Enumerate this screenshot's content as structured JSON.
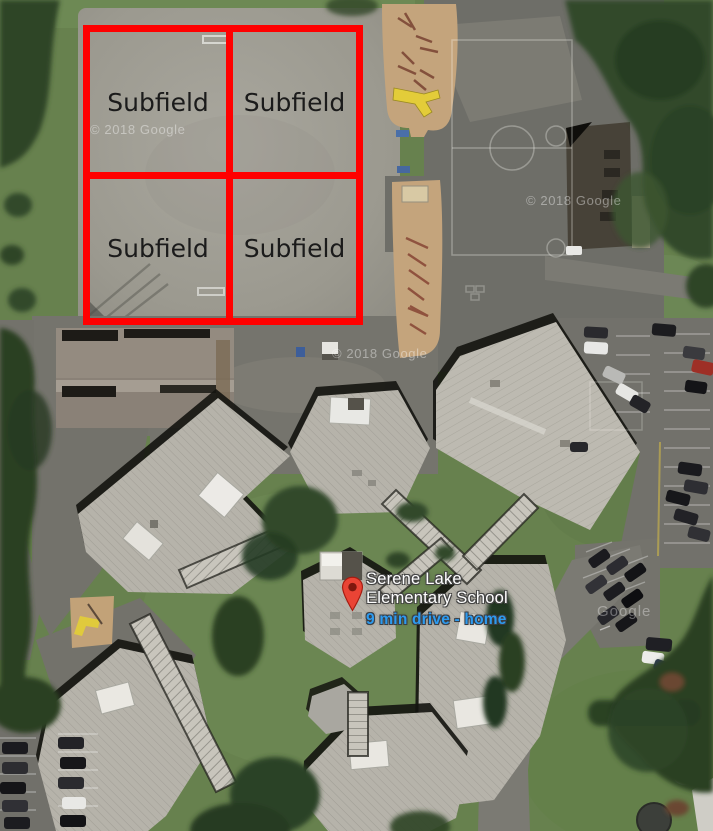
{
  "map": {
    "view": "satellite",
    "attribution": {
      "items": [
        {
          "text": "© 2018 Google"
        },
        {
          "text": "© 2018 Google"
        },
        {
          "text": "© 2018 Google"
        },
        {
          "text": "Google"
        }
      ]
    }
  },
  "overlay": {
    "grid_color": "#ff0000",
    "cells": [
      {
        "label": "Subfield"
      },
      {
        "label": "Subfield"
      },
      {
        "label": "Subfield"
      },
      {
        "label": "Subfield"
      }
    ]
  },
  "marker": {
    "pin_color": "#EA4435",
    "name_line1": "Serene Lake",
    "name_line2": "Elementary School",
    "travel_time": "9 min drive - home",
    "travel_time_color": "#2D9BF0"
  }
}
